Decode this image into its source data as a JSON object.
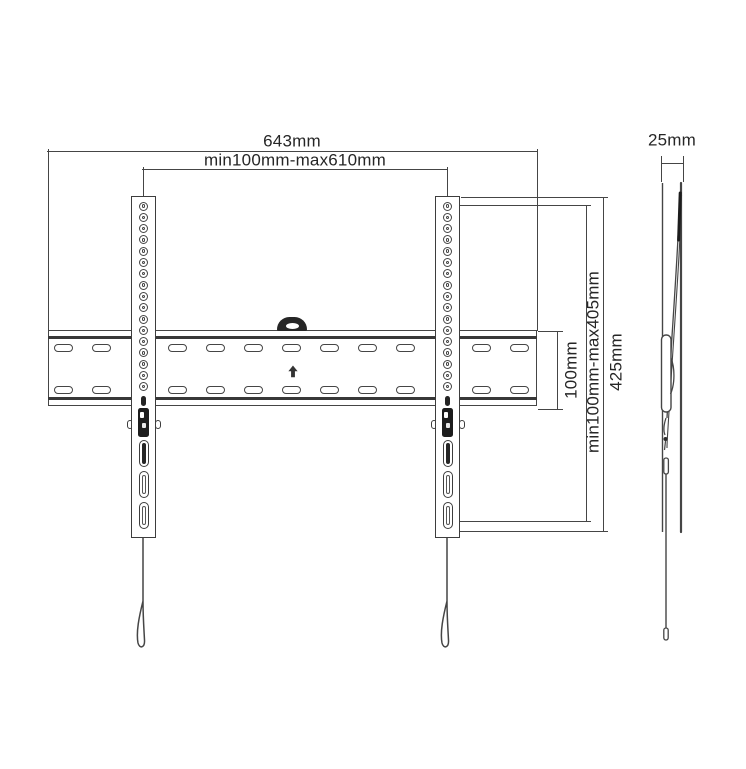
{
  "labels": {
    "total_width": "643mm",
    "mount_width_range": "min100mm-max610mm",
    "plate_height": "100mm",
    "mount_height_range": "min100mm-max405mm",
    "bracket_height": "425mm",
    "profile_depth": "25mm"
  },
  "colors": {
    "line": "#454545",
    "dark_fill": "#1f1f1f",
    "text": "#262626",
    "background": "#ffffff"
  }
}
